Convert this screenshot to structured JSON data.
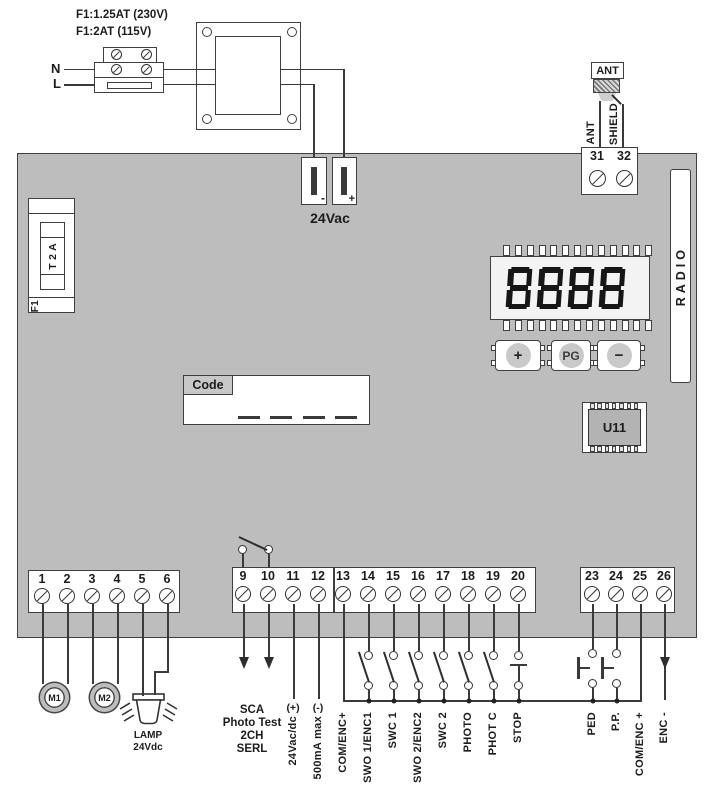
{
  "colors": {
    "board": "#bdbdbd",
    "line": "#3a3a3a",
    "display_bg": "#f3f3f3",
    "button_cap": "#c9c9c9",
    "chip": "#b3b3b3",
    "code_tab": "#c8c8c8"
  },
  "power": {
    "fuse_label_230": "F1:1.25AT (230V)",
    "fuse_label_115": "F1:2AT (115V)",
    "neutral": "N",
    "line": "L",
    "output": "24Vac",
    "minus": "-",
    "plus": "+"
  },
  "antenna": {
    "connector": "ANT",
    "wire_ant": "ANT",
    "wire_shield": "SHIELD",
    "terminals": [
      "31",
      "32"
    ]
  },
  "board": {
    "fuse_id": "F1",
    "fuse_rating": "T 2 A",
    "radio": "RADIO",
    "display_value": "8888",
    "buttons": {
      "plus": "+",
      "program": "PG",
      "minus": "−"
    },
    "chip": "U11",
    "code": "Code",
    "code_slots": 4
  },
  "terminals": {
    "motor_block": [
      "1",
      "2",
      "3",
      "4",
      "5",
      "6"
    ],
    "aux_block": [
      "9",
      "10",
      "11",
      "12"
    ],
    "input_block": [
      "13",
      "14",
      "15",
      "16",
      "17",
      "18",
      "19",
      "20"
    ],
    "command_block": [
      "23",
      "24",
      "25",
      "26"
    ]
  },
  "labels": {
    "m1": "M1",
    "m2": "M2",
    "lamp": "LAMP",
    "lamp_voltage": "24Vdc",
    "sca_lines": [
      "SCA",
      "Photo Test",
      "2CH",
      "SERL"
    ],
    "aux_plus": "(+)",
    "aux_minus": "(-)",
    "aux_supply": "24Vac/dc",
    "aux_current": "500mA max",
    "t13": "COM/ENC+",
    "t14": "SWO 1/ENC1",
    "t15": "SWC 1",
    "t16": "SWO 2/ENC2",
    "t17": "SWC 2",
    "t18": "PHOTO",
    "t19": "PHOT C",
    "t20": "STOP",
    "t23": "PED",
    "t24": "P.P.",
    "t25": "COM/ENC +",
    "t26": "ENC -"
  }
}
